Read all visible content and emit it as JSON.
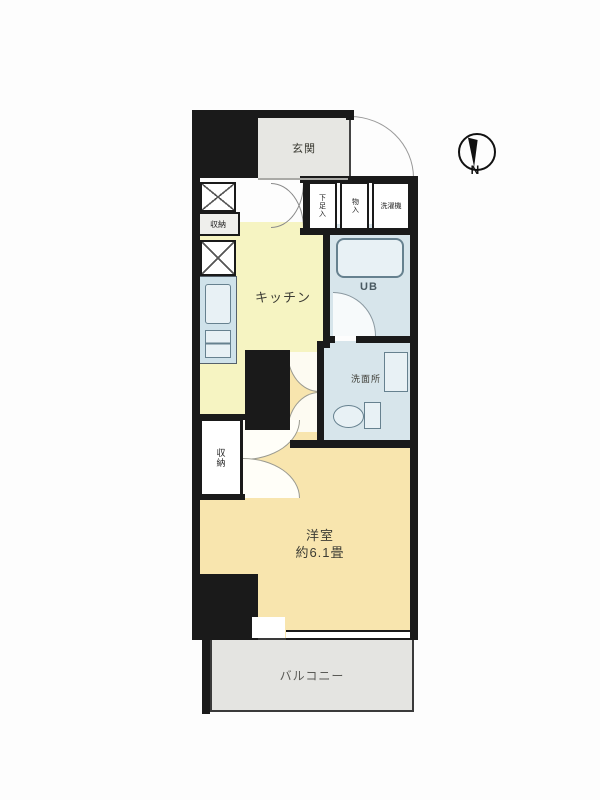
{
  "floorplan": {
    "rooms": {
      "genkan": {
        "label": "玄関"
      },
      "kitchen": {
        "label": "キッチン"
      },
      "unit_bath": {
        "label": "UB"
      },
      "washroom": {
        "label": "洗面所"
      },
      "western_room": {
        "label": "洋室",
        "size": "約6.1畳"
      },
      "balcony": {
        "label": "バルコニー"
      },
      "closet": {
        "label": "収納"
      },
      "hall_storage": {
        "label": "収納"
      },
      "shoe_box": {
        "label": "下足入"
      },
      "cupboard": {
        "label": "物入"
      },
      "washer": {
        "label": "洗濯機"
      }
    },
    "compass": {
      "label": "N"
    },
    "colors": {
      "wall": "#1a1a1a",
      "genkan": "#e7e7e3",
      "kitchen": "#f6f4c2",
      "room": "#f8e5ae",
      "wet": "#d7e5eb",
      "fixture": "#e8f1f5",
      "counter": "#cfe2ea",
      "balcony": "#e4e4e1"
    }
  }
}
